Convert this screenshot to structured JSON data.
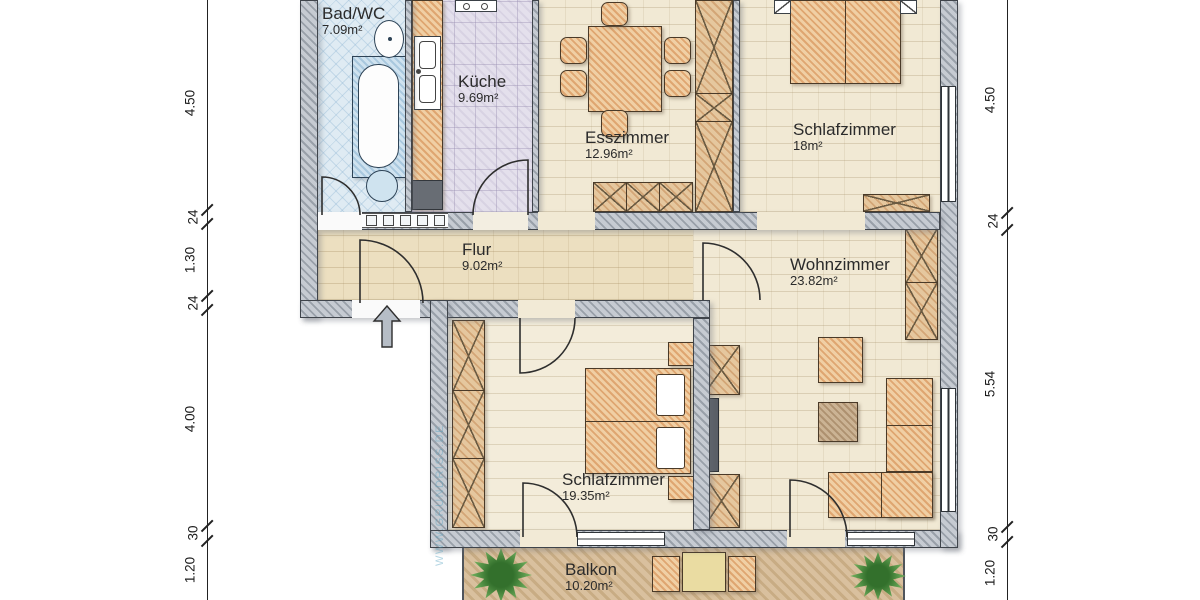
{
  "plan": {
    "rooms": [
      {
        "name": "Bad/WC",
        "area": "7.09m²"
      },
      {
        "name": "Küche",
        "area": "9.69m²"
      },
      {
        "name": "Esszimmer",
        "area": "12.96m²"
      },
      {
        "name": "Schlafzimmer",
        "area": "18m²"
      },
      {
        "name": "Flur",
        "area": "9.02m²"
      },
      {
        "name": "Wohnzimmer",
        "area": "23.82m²"
      },
      {
        "name": "Schlafzimmer",
        "area": "19.35m²"
      },
      {
        "name": "Balkon",
        "area": "10.20m²"
      }
    ],
    "dimensions_left": [
      "4.50",
      "24",
      "1.30",
      "24",
      "4.00",
      "30",
      "1.20"
    ],
    "dimensions_right": [
      "4.50",
      "24",
      "5.54",
      "30",
      "1.20"
    ],
    "watermark": "WWW.GRUNDRISS.DE",
    "colors": {
      "wall": "#a0a7b0",
      "floor": "#f1e9d4",
      "bath_tile": "#dfebf3",
      "kitchen_tile": "#e4e0ec",
      "balcony_wood": "#d8bf9e",
      "furniture": "#e8bb8b",
      "plant": "#4e8f3e"
    }
  }
}
